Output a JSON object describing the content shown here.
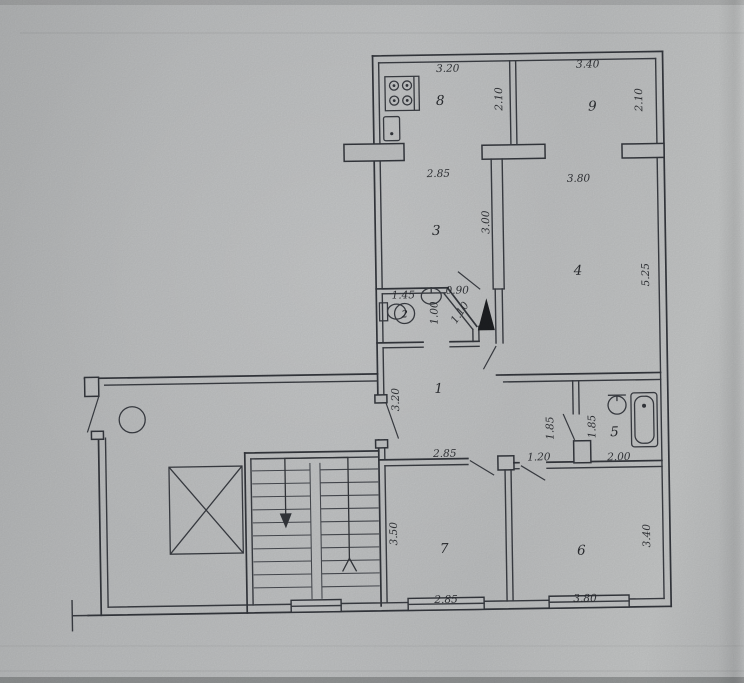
{
  "document": {
    "kind": "scanned apartment floor plan"
  },
  "colors": {
    "paper": "#bfc1c2",
    "ink": "#34373d"
  },
  "icons": [
    "stove-icon",
    "kitchen-sink-icon",
    "toilet-icon",
    "washbasin-icon",
    "bathtub-icon",
    "elevator-shaft-icon",
    "staircase-icon",
    "garbage-chute-icon",
    "vent-duct-icon",
    "window-icon",
    "door-leaf-icon",
    "stair-direction-arrow-icon"
  ],
  "rooms": [
    {
      "number": "1",
      "dims": [
        "3.20",
        "2.85"
      ]
    },
    {
      "number": "2",
      "dims": [
        "1.45",
        "0.90",
        "1.00",
        "1.10"
      ]
    },
    {
      "number": "3",
      "dims": [
        "2.85",
        "3.00"
      ]
    },
    {
      "number": "4",
      "dims": [
        "3.80",
        "5.25"
      ]
    },
    {
      "number": "5",
      "dims": [
        "2.00",
        "1.85",
        "1.85",
        "1.20"
      ]
    },
    {
      "number": "6",
      "dims": [
        "3.80",
        "3.40"
      ]
    },
    {
      "number": "7",
      "dims": [
        "2.85",
        "3.50",
        "2.85"
      ]
    },
    {
      "number": "8",
      "dims": [
        "3.20",
        "2.10"
      ]
    },
    {
      "number": "9",
      "dims": [
        "3.40",
        "2.10"
      ]
    }
  ],
  "labels": {
    "room1": "1",
    "room2": "2",
    "room3": "3",
    "room4": "4",
    "room5": "5",
    "room6": "6",
    "room7": "7",
    "room8": "8",
    "room9": "9",
    "loggia8_width": "3.20",
    "loggia8_depth": "2.10",
    "loggia9_width": "3.40",
    "loggia9_depth": "2.10",
    "room3_width": "2.85",
    "room3_depth": "3.00",
    "room4_width": "3.80",
    "room4_depth": "5.25",
    "wc_width": "1.45",
    "wc_niche_width": "0.90",
    "wc_niche_depth": "1.00",
    "wc_niche_diag": "1.10",
    "hall_depth": "3.20",
    "hall_width": "2.85",
    "corridor_width": "1.20",
    "bath_width": "2.00",
    "closet_depth": "1.85",
    "bath_depth": "1.85",
    "room7_depth": "3.50",
    "room7_width_bottom": "2.85",
    "room6_depth": "3.40",
    "room6_width": "3.80"
  }
}
